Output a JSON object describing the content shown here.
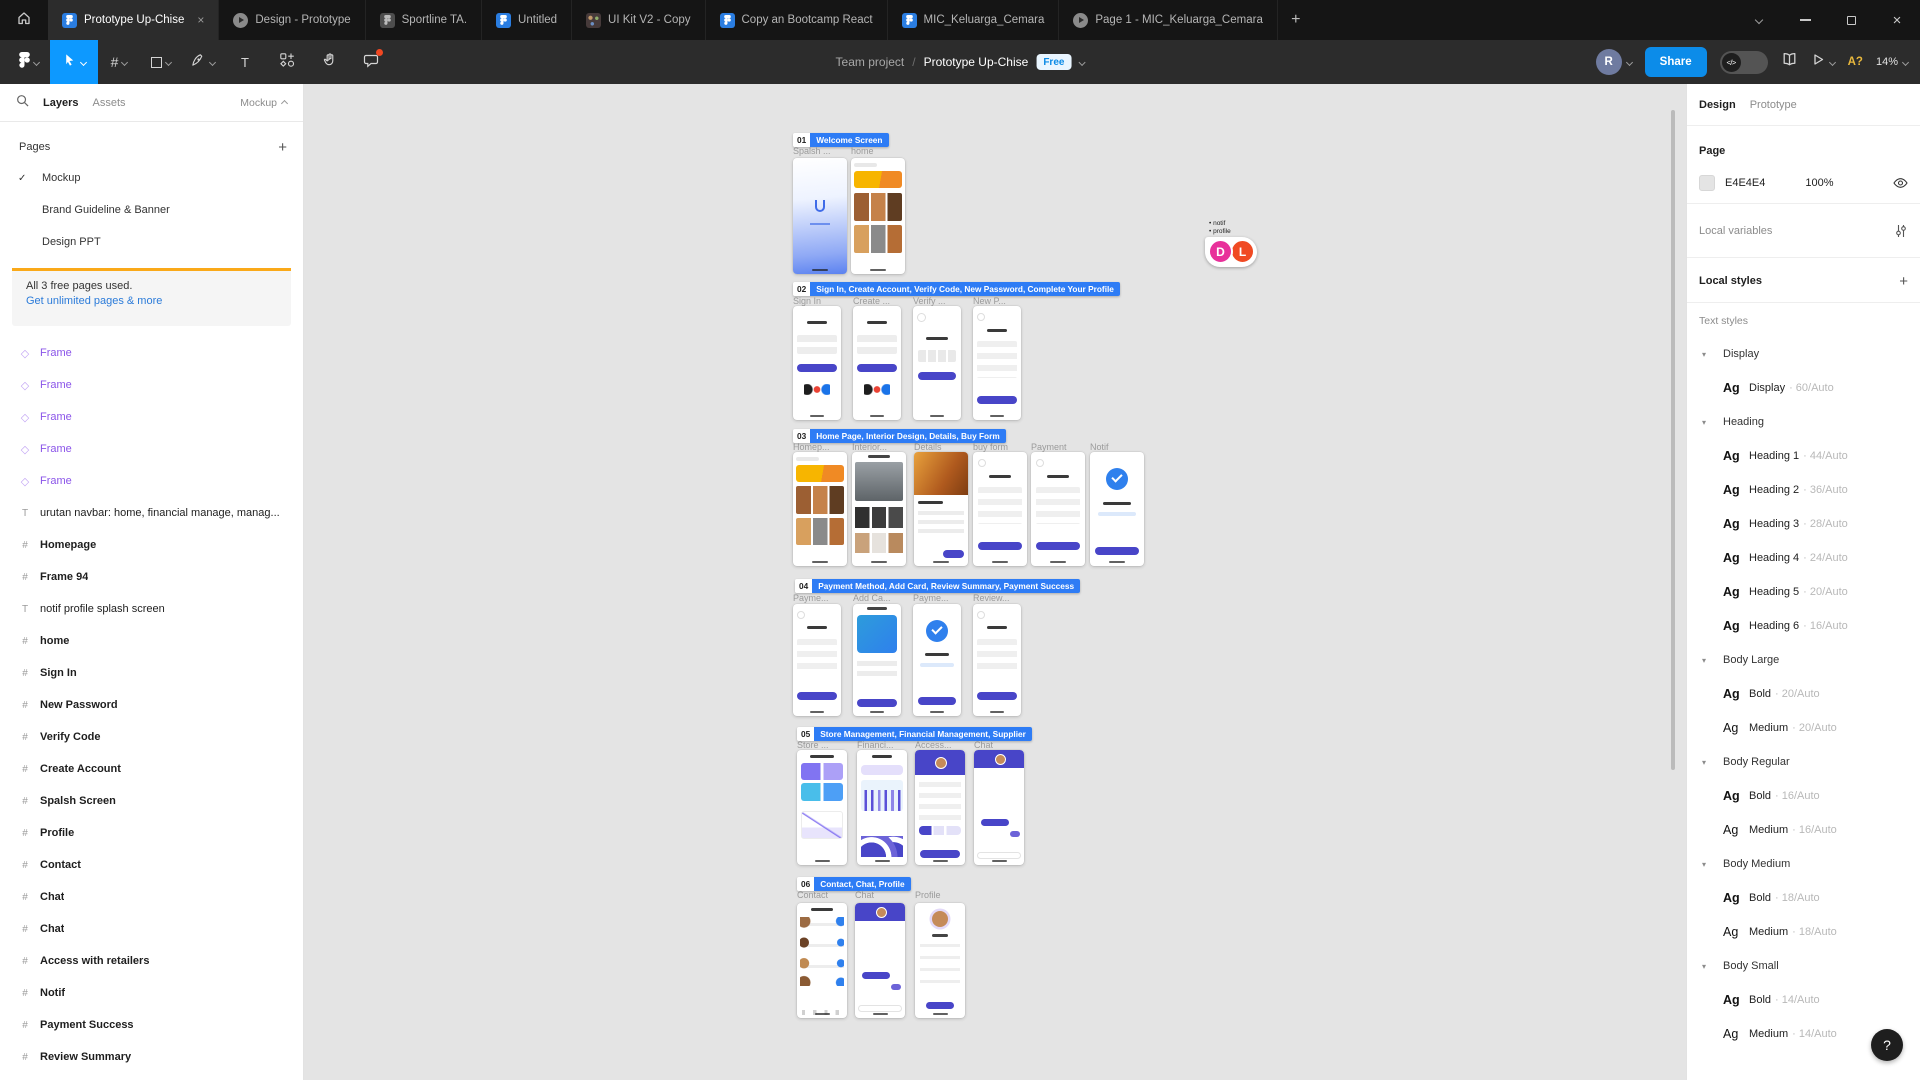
{
  "colors": {
    "accent_blue": "#0D99FF",
    "section_label_blue": "#2E7CF5",
    "notice_bar_yellow": "#FAA919",
    "component_purple": "#8B55E9",
    "mockup_indigo": "#4845C8",
    "canvas_bg": "#E4E4E4",
    "cursor_d_pink": "#E8309A",
    "cursor_l_orange": "#F04A23"
  },
  "titlebar": {
    "tabs": [
      {
        "label": "Prototype Up-Chise",
        "icon": "figma-file-icon",
        "active": true,
        "close": "×"
      },
      {
        "label": "Design - Prototype",
        "icon": "prototype-play-icon"
      },
      {
        "label": "Sportline TA.",
        "icon": "figma-file-icon-gray"
      },
      {
        "label": "Untitled",
        "icon": "figma-file-icon"
      },
      {
        "label": "UI Kit V2 - Copy",
        "icon": "palette-icon"
      },
      {
        "label": "Copy an Bootcamp React",
        "icon": "figma-file-icon"
      },
      {
        "label": "MIC_Keluarga_Cemara",
        "icon": "figma-file-icon"
      },
      {
        "label": "Page 1 - MIC_Keluarga_Cemara",
        "icon": "prototype-play-icon"
      }
    ],
    "new_tab": "+"
  },
  "toolbar": {
    "breadcrumb": {
      "project": "Team project",
      "divider": "/",
      "file": "Prototype Up-Chise",
      "plan_badge": "Free"
    },
    "share_label": "Share",
    "avatar_initial": "R",
    "font_warning": "A?",
    "zoom_level": "14%",
    "tools": [
      "figma-menu",
      "move",
      "frame",
      "shape",
      "pen",
      "text",
      "actions",
      "hand",
      "comment"
    ]
  },
  "left_panel": {
    "tabs": {
      "layers": "Layers",
      "assets": "Assets"
    },
    "page_dropdown": "Mockup",
    "pages_header": "Pages",
    "pages": [
      {
        "name": "Mockup",
        "selected": true
      },
      {
        "name": "Brand Guideline & Banner",
        "selected": false
      },
      {
        "name": "Design PPT",
        "selected": false
      }
    ],
    "notice": {
      "message": "All 3 free pages used.",
      "link": "Get unlimited pages & more"
    },
    "layers": [
      {
        "type": "instance",
        "label": "Frame"
      },
      {
        "type": "instance",
        "label": "Frame"
      },
      {
        "type": "instance",
        "label": "Frame"
      },
      {
        "type": "instance",
        "label": "Frame"
      },
      {
        "type": "instance",
        "label": "Frame"
      },
      {
        "type": "text",
        "label": "urutan navbar: home, financial manage, manag..."
      },
      {
        "type": "frame",
        "label": "Homepage"
      },
      {
        "type": "frame",
        "label": "Frame 94"
      },
      {
        "type": "text",
        "label": "notif profile splash screen"
      },
      {
        "type": "frame",
        "label": "home"
      },
      {
        "type": "frame",
        "label": "Sign In"
      },
      {
        "type": "frame",
        "label": "New Password"
      },
      {
        "type": "frame",
        "label": "Verify Code"
      },
      {
        "type": "frame",
        "label": "Create Account"
      },
      {
        "type": "frame",
        "label": "Spalsh Screen"
      },
      {
        "type": "frame",
        "label": "Profile"
      },
      {
        "type": "frame",
        "label": "Contact"
      },
      {
        "type": "frame",
        "label": "Chat"
      },
      {
        "type": "frame",
        "label": "Chat"
      },
      {
        "type": "frame",
        "label": "Access with retailers"
      },
      {
        "type": "frame",
        "label": "Notif"
      },
      {
        "type": "frame",
        "label": "Payment Success"
      },
      {
        "type": "frame",
        "label": "Review Summary"
      }
    ]
  },
  "canvas": {
    "sections": [
      {
        "num": "01",
        "title": "Welcome Screen",
        "frames": [
          "Spalsh ...",
          "home"
        ]
      },
      {
        "num": "02",
        "title": "Sign In, Create Account, Verify Code, New Password, Complete Your Profile",
        "frames": [
          "Sign In",
          "Create ...",
          "Verify ...",
          "New P..."
        ]
      },
      {
        "num": "03",
        "title": "Home Page, Interior Design, Details, Buy Form",
        "frames": [
          "Homep...",
          "Interior...",
          "Details",
          "buy form",
          "Payment",
          "Notif"
        ]
      },
      {
        "num": "04",
        "title": "Payment Method, Add Card, Review Summary, Payment Success",
        "frames": [
          "Payme...",
          "Add Ca...",
          "Payme...",
          "Review..."
        ]
      },
      {
        "num": "05",
        "title": "Store Management, Financial Management, Supplier",
        "frames": [
          "Store ...",
          "Financi...",
          "Access...",
          "Chat"
        ]
      },
      {
        "num": "06",
        "title": "Contact, Chat, Profile",
        "frames": [
          "Contact",
          "Chat",
          "Profile"
        ]
      }
    ],
    "collaborator_cursor": {
      "note_lines": [
        "• notif",
        "• profile"
      ],
      "avatars": [
        {
          "initial": "D"
        },
        {
          "initial": "L"
        }
      ]
    }
  },
  "right_panel": {
    "tabs": {
      "design": "Design",
      "prototype": "Prototype"
    },
    "page": {
      "title": "Page",
      "hex": "E4E4E4",
      "opacity": "100%"
    },
    "local_variables": "Local variables",
    "local_styles": "Local styles",
    "text_styles_header": "Text styles",
    "style_rows": [
      {
        "kind": "group",
        "name": "Display"
      },
      {
        "kind": "style",
        "sample": "Ag",
        "name": "Display",
        "meta": "· 60/Auto",
        "bold_sample": true
      },
      {
        "kind": "group",
        "name": "Heading"
      },
      {
        "kind": "style",
        "sample": "Ag",
        "name": "Heading 1",
        "meta": "· 44/Auto",
        "bold_sample": true
      },
      {
        "kind": "style",
        "sample": "Ag",
        "name": "Heading 2",
        "meta": "· 36/Auto",
        "bold_sample": true
      },
      {
        "kind": "style",
        "sample": "Ag",
        "name": "Heading 3",
        "meta": "· 28/Auto",
        "bold_sample": true
      },
      {
        "kind": "style",
        "sample": "Ag",
        "name": "Heading 4",
        "meta": "· 24/Auto",
        "bold_sample": true
      },
      {
        "kind": "style",
        "sample": "Ag",
        "name": "Heading 5",
        "meta": "· 20/Auto",
        "bold_sample": true
      },
      {
        "kind": "style",
        "sample": "Ag",
        "name": "Heading 6",
        "meta": "· 16/Auto",
        "bold_sample": true
      },
      {
        "kind": "group",
        "name": "Body Large"
      },
      {
        "kind": "style",
        "sample": "Ag",
        "name": "Bold",
        "meta": "· 20/Auto",
        "bold_sample": true
      },
      {
        "kind": "style",
        "sample": "Ag",
        "name": "Medium",
        "meta": "· 20/Auto",
        "bold_sample": false
      },
      {
        "kind": "group",
        "name": "Body Regular"
      },
      {
        "kind": "style",
        "sample": "Ag",
        "name": "Bold",
        "meta": "· 16/Auto",
        "bold_sample": true
      },
      {
        "kind": "style",
        "sample": "Ag",
        "name": "Medium",
        "meta": "· 16/Auto",
        "bold_sample": false
      },
      {
        "kind": "group",
        "name": "Body Medium"
      },
      {
        "kind": "style",
        "sample": "Ag",
        "name": "Bold",
        "meta": "· 18/Auto",
        "bold_sample": true
      },
      {
        "kind": "style",
        "sample": "Ag",
        "name": "Medium",
        "meta": "· 18/Auto",
        "bold_sample": false
      },
      {
        "kind": "group",
        "name": "Body Small"
      },
      {
        "kind": "style",
        "sample": "Ag",
        "name": "Bold",
        "meta": "· 14/Auto",
        "bold_sample": true
      },
      {
        "kind": "style",
        "sample": "Ag",
        "name": "Medium",
        "meta": "· 14/Auto",
        "bold_sample": false
      }
    ]
  },
  "help_button": "?"
}
